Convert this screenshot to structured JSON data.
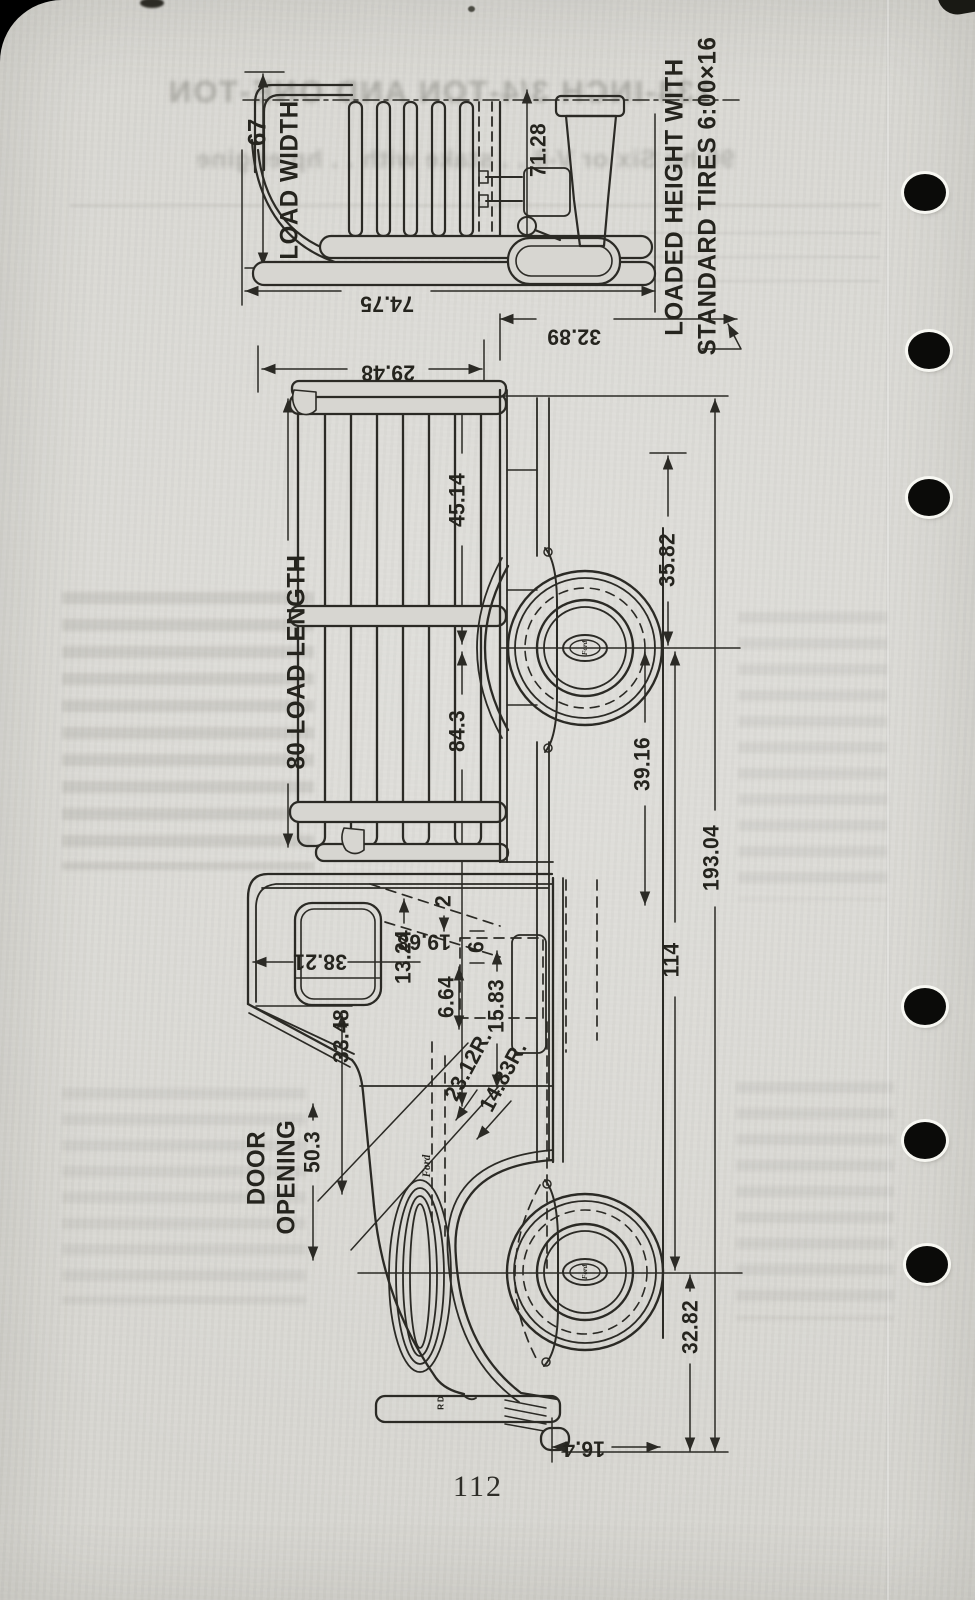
{
  "page": {
    "number": "112"
  },
  "diagram": {
    "labels": {
      "load_width_value": "67",
      "load_width": "LOAD WIDTH",
      "loaded_height_line1": "LOADED HEIGHT WITH",
      "loaded_height_line2": "STANDARD TIRES 6:00×16",
      "dim_71_28": "71.28",
      "dim_74_75": "74.75",
      "dim_32_89": "32.89",
      "dim_29_48": "29.48",
      "dim_45_14": "45.14",
      "dim_35_82": "35.82",
      "load_length": "80 LOAD LENGTH",
      "dim_84_3": "84.3",
      "dim_39_16": "39.16",
      "dim_193_04": "193.04",
      "dim_114": "114",
      "dim_38_21": "38.21",
      "dim_13_24": "13.24",
      "dim_19_68": "19.68",
      "dim_2": "2",
      "dim_6": "6",
      "dim_6_64": "6.64",
      "dim_15_83": "15.83",
      "dim_23_12r": "23.12R.",
      "dim_14_83r": "14.83R.",
      "dim_33_48": "33.48",
      "dim_50_3": "50.3",
      "door_line1": "DOOR",
      "door_line2": "OPENING",
      "dim_32_82": "32.82",
      "dim_16_4": "16.4",
      "ford_script_grille": "Ford",
      "ford_script_hub_rear": "Ford",
      "ford_script_hub_front": "Ford",
      "rd_mark": "RD"
    }
  },
  "bleed_through": {
    "line1": "134-INCH 3/4-TON AND ONE-TON",
    "line2": "90 hp Six or V-8 . . stake with . . hp engine"
  },
  "colors": {
    "paper": "#d7d6d1",
    "ink": "#2b2a25"
  }
}
